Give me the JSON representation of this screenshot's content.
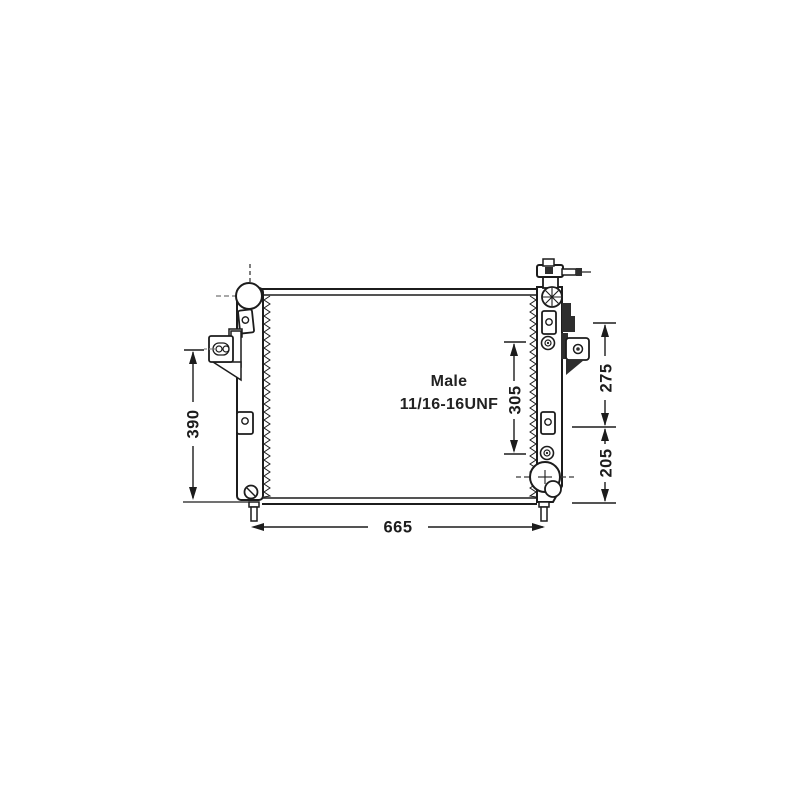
{
  "title": "Radiator technical line drawing",
  "drawing": {
    "fitting_note_line1": "Male",
    "fitting_note_line2": "11/16-16UNF",
    "dim_core_width": "665",
    "dim_core_height": "390",
    "dim_fitting_spacing": "305",
    "dim_upper_right": "275",
    "dim_lower_right": "205"
  },
  "colors": {
    "ink": "#1c1c1c",
    "dark_fill": "#2e2e2e",
    "dash_gray": "#8c8c8c",
    "background": "#ffffff"
  }
}
